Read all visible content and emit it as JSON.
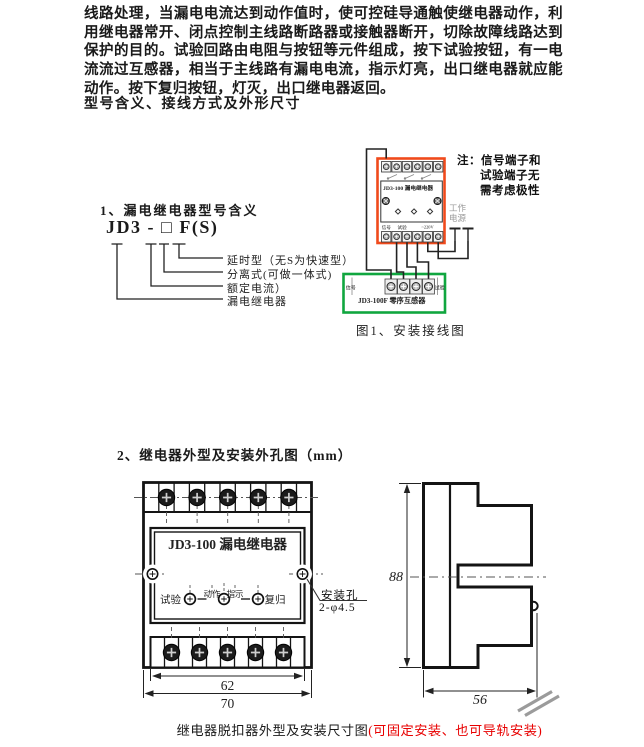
{
  "intro": {
    "paragraph": "线路处理，当漏电电流达到动作值时，使可控硅导通触使继电器动作，利用继电器常开、闭点控制主线路断路器或接触器断开，切除故障线路达到保护的目的。试验回路由电阻与按钮等元件组成，按下试验按钮，有一电流流过互感器，相当于主线路有漏电电流，指示灯亮，出口继电器就应能动作。按下复归按钮，灯灭，出口继电器返回。"
  },
  "headings": {
    "section1": "型号含义、接线方式及外形尺寸",
    "model_title": "1、漏电继电器型号含义",
    "section2": "2、继电器外型及安装外孔图（mm）"
  },
  "model_diagram": {
    "code": "JD3 - □ F(S)",
    "label_delay": "延时型（无S为快速型）",
    "label_split": "分离式(可做一体式)",
    "label_current": "额定电流）",
    "label_relay": "漏电继电器"
  },
  "wiring": {
    "relay_title": "JD3-100 漏电继电器",
    "relay_term_signal": "信号",
    "relay_term_test": "试验",
    "relay_term_power": "~220V",
    "note_line1": "注：信号端子和",
    "note_line2": "试验端子无",
    "note_line3": "需考虑极性",
    "power_label": "工作电源",
    "ct_label_left": "信号",
    "ct_label_right": "试验",
    "ct_title": "JD3-100F 零序互感器",
    "caption": "图1、安装接线图"
  },
  "outline": {
    "front": {
      "title": "JD3-100 漏电继电器",
      "btn_test": "试验",
      "btn_action": "动作",
      "btn_indicate": "指示",
      "btn_reset": "复归",
      "hole_label": "安装孔",
      "hole_size": "2-φ4.5",
      "dim_inner": "62",
      "dim_outer": "70"
    },
    "side": {
      "dim_height": "88",
      "dim_depth": "56"
    }
  },
  "footer": {
    "caption_black": "继电器脱扣器外型及安装尺寸图",
    "caption_red": "(可固定安装、也可导轨安装)"
  },
  "colors": {
    "relay_box_border": "#f04a1c",
    "ct_box_border": "#10a63f",
    "red_text": "#e80000"
  }
}
